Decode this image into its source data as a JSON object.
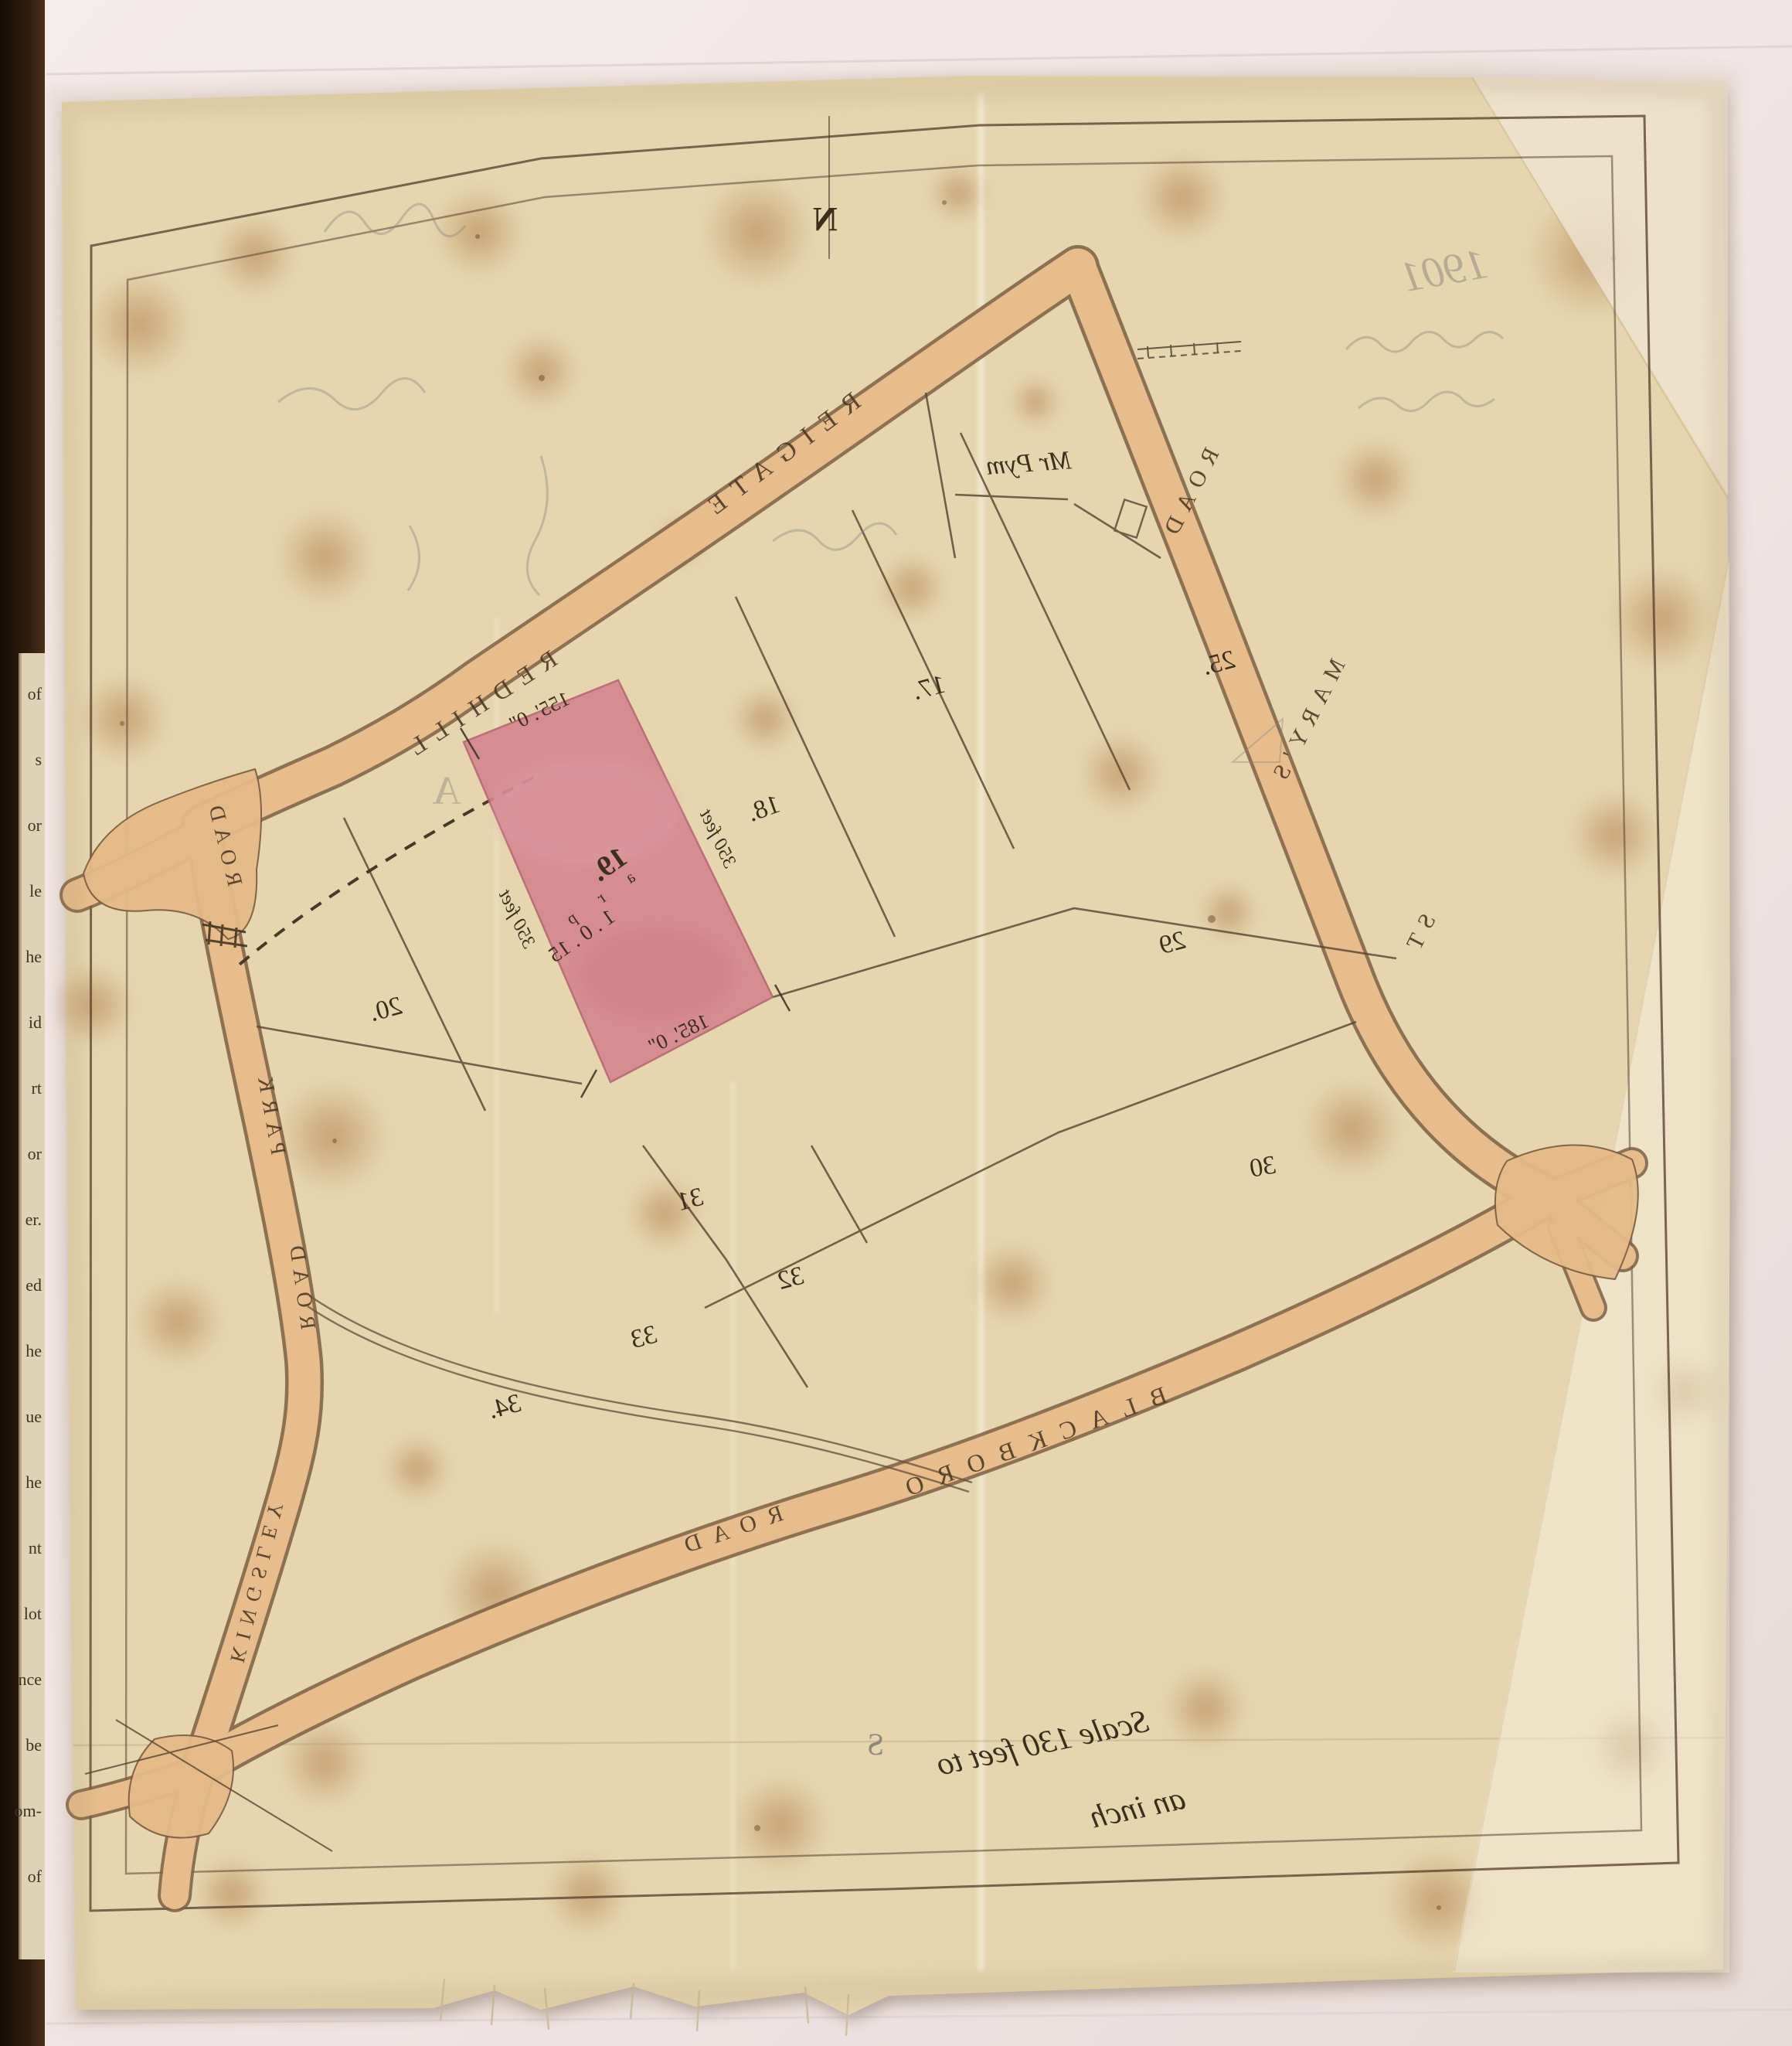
{
  "document_kind": "scanned hand-drawn plot plan on tracing cloth, lettering mirrored (viewed from verso)",
  "colors": {
    "backing_sheet": "#f0e6e5",
    "cloth": "#e6d6b0",
    "road_fill": "#e7bd8d",
    "road_edge": "#7d5f42",
    "plot_highlight_pink": "#d4848f",
    "ink": "#3d2e1c",
    "pencil": "#8f897b",
    "book_edge": "#1d120a"
  },
  "map": {
    "mirrored": true,
    "compass": {
      "north": "N",
      "south": "S"
    },
    "roads": {
      "reigate": "REIGATE",
      "redhill": "REDHILL",
      "road_west": "ROAD",
      "st_marys": [
        "ST",
        "MARY'S",
        "ROAD"
      ],
      "blackboro": "BLACKBORO",
      "blackboro_road": "ROAD",
      "park": [
        "PARK",
        "ROAD"
      ],
      "kingsley": "KINGSLEY"
    },
    "owner_label": "Mr Pym",
    "plot19": {
      "number": "19.",
      "area_units": "a r p",
      "area": "1 . 0 . 15",
      "edge_top": "155'. 0\"",
      "edge_bottom": "185'. 0\"",
      "side_left": "350 feet",
      "side_right": "350 feet"
    },
    "plot_numbers": {
      "p20": "20.",
      "p18": "18.",
      "p17": "17.",
      "p25": "25.",
      "p29": "29",
      "p30": "30",
      "p31": "31",
      "p32": "32",
      "p33": "33",
      "p34": "34."
    },
    "scale_note": {
      "line1": "Scale 130 feet to",
      "line2": "an inch"
    },
    "pencil_notes": {
      "year": "1901",
      "mark_a": "A"
    }
  },
  "book_edge": {
    "fragments": [
      "of",
      "s",
      "or",
      "le",
      "he",
      "id",
      "rt",
      "or",
      "er.",
      "ed",
      "he",
      "ue",
      "he",
      "nt",
      "lot",
      "nce",
      "be",
      "om-",
      "of"
    ]
  }
}
